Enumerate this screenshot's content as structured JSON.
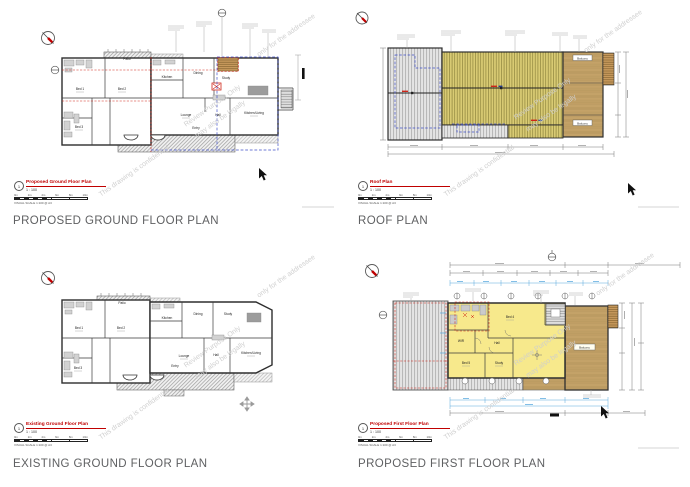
{
  "watermark": {
    "line_confidential": "This drawing is confidential",
    "line_review": "Review Purpose Only",
    "line_legal": "may also be legally",
    "line_addressee": "only for the addressee"
  },
  "scale_bar": {
    "ticks": [
      "0m",
      "2m",
      "4m",
      "6m",
      "8m",
      "10m"
    ]
  },
  "panels": {
    "proposed_ground": {
      "caption": "PROPOSED GROUND FLOOR PLAN",
      "title": "Proposed Ground Floor Plan",
      "number": "1",
      "scale": "1 : 100",
      "visual_scale": "VISUAL SCALE 1:100 @ A3",
      "rooms": {
        "bed1": "Bed 1",
        "bed2": "Bed 2",
        "bed3": "Bed 3",
        "kitchen": "Kitchen",
        "dining": "Dining",
        "study": "Study",
        "lounge": "Lounge",
        "hall": "Hall",
        "kitchen_living": "Kitchen/Living",
        "patio": "Patio",
        "entry": "Entry"
      }
    },
    "roof": {
      "caption": "ROOF PLAN",
      "title": "Roof Plan",
      "number": "1",
      "scale": "1 : 100",
      "visual_scale": "VISUAL SCALE 1:100 @ A3",
      "labels": {
        "balcony_top": "Balcony",
        "balcony_bottom": "Balcony"
      }
    },
    "existing_ground": {
      "caption": "EXISTING GROUND FLOOR PLAN",
      "title": "Existing Ground Floor Plan",
      "number": "1",
      "scale": "1 : 100",
      "visual_scale": "VISUAL SCALE 1:100 @ A3",
      "rooms": {
        "bed1": "Bed 1",
        "bed2": "Bed 2",
        "bed3": "Bed 3",
        "kitchen": "Kitchen",
        "dining": "Dining",
        "study": "Study",
        "lounge": "Lounge",
        "hall": "Hall",
        "kitchen_living": "Kitchen/Living",
        "patio": "Patio",
        "entry": "Entry"
      }
    },
    "proposed_first": {
      "caption": "PROPOSED FIRST FLOOR PLAN",
      "title": "Proposed First Floor Plan",
      "number": "1",
      "scale": "1 : 100",
      "visual_scale": "VISUAL SCALE 1:100 @ A3",
      "rooms": {
        "bed4": "Bed 4",
        "bed5": "Bed 5",
        "study": "Study",
        "wir": "WIR",
        "hall": "Hall",
        "balcony": "Balcony"
      }
    }
  },
  "colors": {
    "title_red": "#c00000",
    "caption_gray": "#5f6062",
    "new_roof_olive": "#d9cb74",
    "existing_roof_gray": "#e4e4e4",
    "balcony_tan": "#cfae72",
    "room_yellow": "#f7e98c",
    "demolition_red": "#cf2518",
    "proposed_blue": "#4050c8",
    "dimension_blue": "#58a8dd",
    "watermark_gray": "#cecece"
  }
}
